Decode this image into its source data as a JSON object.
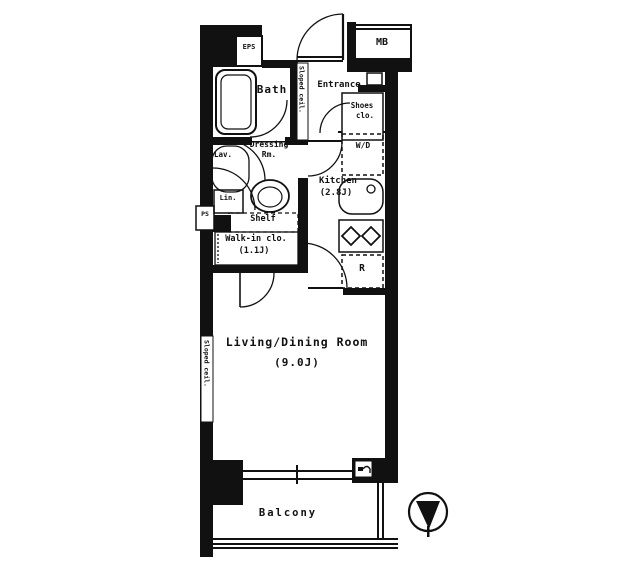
{
  "plan": {
    "rooms": {
      "eps": "EPS",
      "meter_box": "MB",
      "bath": "Bath",
      "entrance": "Entrance",
      "shoes_line1": "Shoes",
      "shoes_line2": "clo.",
      "sloped_ceiling_entrance": "Sloped ceil.",
      "sloped_ceiling_living": "Sloped ceil.",
      "dressing_line1": "Dressing",
      "dressing_line2": "Rm.",
      "lavatory": "Lav.",
      "linen": "Lin.",
      "pipe_space": "PS",
      "shelf": "Shelf",
      "walkin_line1": "Walk-in clo.",
      "walkin_size": "(1.1J)",
      "kitchen": "Kitchen",
      "kitchen_size": "(2.8J)",
      "washer_dryer": "W/D",
      "refrigerator": "R",
      "living_line1": "Living/Dining Room",
      "living_size": "(9.0J)",
      "balcony": "Balcony"
    },
    "colors": {
      "wall": "#111111",
      "background": "#ffffff",
      "line": "#111111"
    }
  }
}
